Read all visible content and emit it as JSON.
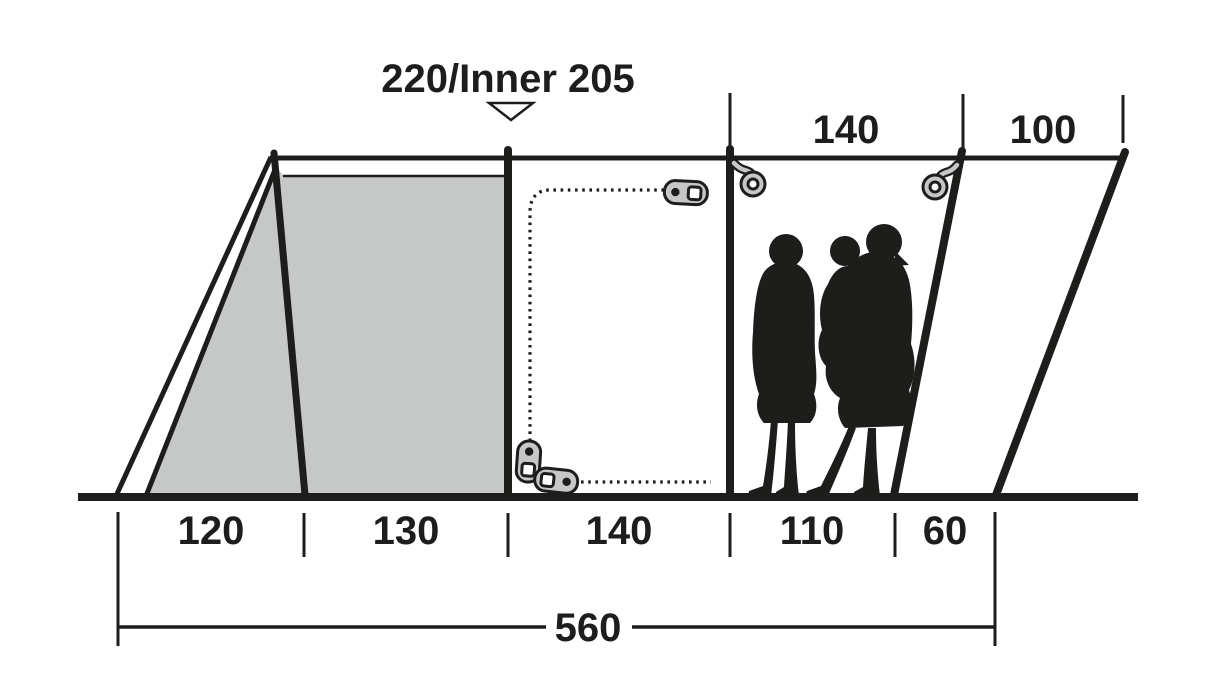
{
  "title": "220/Inner 205",
  "dimensions": {
    "top": [
      {
        "value": "140"
      },
      {
        "value": "100"
      }
    ],
    "bottom": [
      {
        "value": "120"
      },
      {
        "value": "130"
      },
      {
        "value": "140"
      },
      {
        "value": "110"
      },
      {
        "value": "60"
      }
    ],
    "total": "560"
  },
  "colors": {
    "line": "#1d1d1b",
    "inner_tent_fill": "#c6c7c7",
    "background": "#ffffff"
  },
  "icons": {
    "height_marker": "down-triangle-icon",
    "hanging_points": "ring-hook-icon",
    "door": "zipper-pull-icon"
  }
}
